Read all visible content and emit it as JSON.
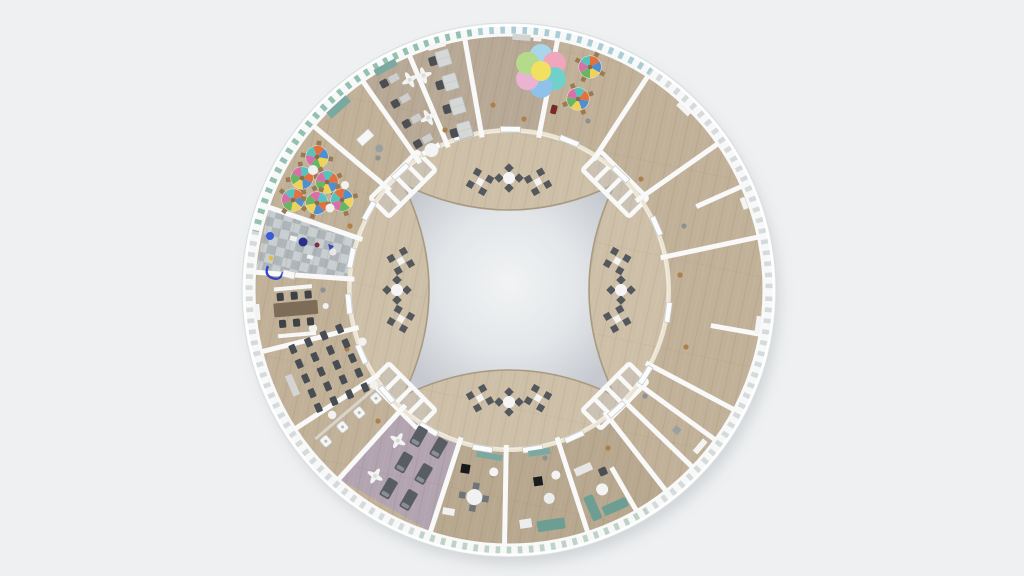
{
  "meta": {
    "title": "Top-down 3D render of a circular single-storey building floor plan",
    "view": "orthographic top view",
    "visible_text": "none"
  },
  "palette": {
    "bg": "#eef0f1",
    "shell": "#fafbfb",
    "shellEdge": "#d9dddf",
    "rimBand": "#d6dada",
    "rimTick": "#f7f9f9",
    "rimTeal": "#8fbfae",
    "rimBlue": "#a8ccd5",
    "rimGreen": "#b9cfc1",
    "wood": "#c1b199",
    "woodLight": "#cec0a8",
    "atriumCenter": "#f1f3f4",
    "atriumMid": "#e3e6e9",
    "atriumEdge": "#c6cad0",
    "atriumRim": "#a89a80",
    "wall": "#f8f9f8",
    "innerWall": "#ece5d3",
    "chairDark": "#4b4f54",
    "clusterChair": "#54585c",
    "tableWhite": "#f3f4f3",
    "sofaTeal": "#6d9e93",
    "counterTeal": "#7ba8a0",
    "napFloor": "#b2a4b0",
    "cot": "#585c63",
    "checkerA": "#c9ced0",
    "checkerB": "#adb5b9",
    "deskGray": "#d6d8d7",
    "woodDot": "#ad7f4c",
    "grayDot": "#8c9294",
    "flowerYellow": "#f2e160"
  },
  "flowerRug": {
    "petals": [
      "#aad6ec",
      "#f0a6bd",
      "#6fd0cc",
      "#8fc2ea",
      "#eab3d2",
      "#b5da8c"
    ],
    "center": "#f2e160",
    "petal_count": 6
  },
  "kidsTable": {
    "wedges": [
      "#e4703c",
      "#4f8fd0",
      "#efd257",
      "#68b565",
      "#d870a8",
      "#58c2bd"
    ],
    "chair_color": "#9b7a50"
  },
  "scene": {
    "building": {
      "shape": "circular",
      "outer_ring": "wedge-shaped rooms with wooden floors and perimeter windows",
      "core": "ring corridor around a light concave-square atrium",
      "staircases_at_atrium_corners": 4
    },
    "corridor": {
      "seating_clusters": 12,
      "seats_per_cluster": 4,
      "cluster_layout": "three clusters at each compass side of the atrium"
    },
    "atrium": {
      "shape": "square with concave arc sides (four-pointed)",
      "floor": "light grey"
    },
    "rooms": [
      {
        "name": "flower-rug room",
        "contents": "pastel flower-shaped rug, small cabinet, dark red chair"
      },
      {
        "name": "kids activity room",
        "contents": "two round multicolour kids tables with chairs"
      },
      {
        "name": "meeting room north-east",
        "contents": "empty, wall art"
      },
      {
        "name": "open room north-east",
        "contents": "empty, partial partition"
      },
      {
        "name": "open hall east",
        "contents": "empty wooden hall, partial partition"
      },
      {
        "name": "utility room south-east 1",
        "contents": "empty"
      },
      {
        "name": "utility room south-east 2",
        "contents": "empty"
      },
      {
        "name": "utility room south-east 3",
        "contents": "empty"
      },
      {
        "name": "lounge south-east",
        "contents": "two teal sofas, round table, desk, chair"
      },
      {
        "name": "lounge south",
        "contents": "teal sofa, tables, black seat, teal counter"
      },
      {
        "name": "lounge south-west",
        "contents": "round table with four chairs, teal counter"
      },
      {
        "name": "nap room",
        "contents": "lavender floor, six cots, two ceiling fans"
      },
      {
        "name": "washroom",
        "contents": "row of four white sinks with counter"
      },
      {
        "name": "classroom",
        "contents": "grid of twenty dark desks, white stools, teacher counter"
      },
      {
        "name": "conference room",
        "contents": "long brown table, six chairs, two white benches"
      },
      {
        "name": "checkered playroom",
        "contents": "grey checkerboard floor, colourful toys, blue slide"
      },
      {
        "name": "kindergarten room",
        "contents": "six round multicolour tables with chairs, white beanbags"
      },
      {
        "name": "storage room",
        "contents": "teal cabinet, white crate, grey stool"
      },
      {
        "name": "open office B",
        "contents": "four workstations, two ceiling fans, teal cabinet, round table"
      },
      {
        "name": "open office A",
        "contents": "four desk units with chairs, ceiling fan, whiteboard"
      }
    ]
  }
}
